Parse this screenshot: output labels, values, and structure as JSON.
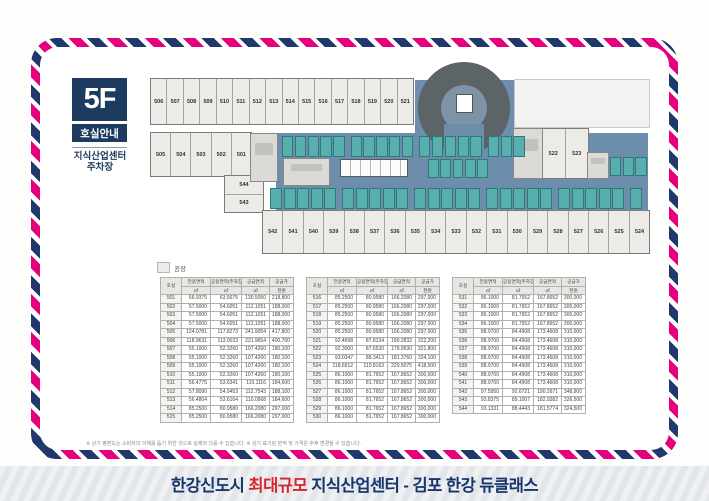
{
  "header": {
    "floor_badge": "5F",
    "badge_subtitle": "호실안내",
    "building_type_line1": "지식산업센터",
    "building_type_line2": "주차장"
  },
  "legend": {
    "factory_label": "공장"
  },
  "floorplan": {
    "top_row": [
      "506",
      "507",
      "508",
      "509",
      "510",
      "511",
      "512",
      "513",
      "514",
      "515",
      "516",
      "517",
      "518",
      "519",
      "520",
      "521"
    ],
    "left_row": [
      "505",
      "504",
      "503",
      "502",
      "501"
    ],
    "left_stack": [
      "544",
      "543"
    ],
    "right_units": [
      "522",
      "523"
    ],
    "bottom_row": [
      "542",
      "541",
      "540",
      "539",
      "538",
      "537",
      "536",
      "535",
      "534",
      "533",
      "532",
      "531",
      "530",
      "529",
      "528",
      "527",
      "526",
      "525",
      "524"
    ]
  },
  "table_headers": {
    "unit": "호실",
    "exclusive_area": "전용면적",
    "common_area": "공용면적(주차장포함)",
    "supply_area": "공급면적",
    "price": "공급가",
    "sqm": "㎡",
    "currency": "천원"
  },
  "tables": {
    "group1": [
      [
        "501",
        "66.9375",
        "63.5675",
        "130.5050",
        "218,800"
      ],
      [
        "502",
        "57.5000",
        "54.6051",
        "112.1051",
        "188,000"
      ],
      [
        "503",
        "57.5000",
        "54.6051",
        "112.1051",
        "188,000"
      ],
      [
        "504",
        "57.5000",
        "54.6051",
        "112.1051",
        "188,000"
      ],
      [
        "505",
        "124.0781",
        "117.8273",
        "241.9054",
        "417,800"
      ],
      [
        "506",
        "118.9631",
        "113.0023",
        "231.9654",
        "400,700"
      ],
      [
        "507",
        "55.1000",
        "52.3260",
        "107.4260",
        "180,100"
      ],
      [
        "508",
        "55.1000",
        "52.3260",
        "107.4260",
        "180,100"
      ],
      [
        "509",
        "55.1000",
        "52.3260",
        "107.4260",
        "180,100"
      ],
      [
        "510",
        "55.1000",
        "52.3260",
        "107.4260",
        "180,100"
      ],
      [
        "511",
        "56.4775",
        "53.6341",
        "110.1116",
        "184,600"
      ],
      [
        "512",
        "57.8090",
        "54.9453",
        "112.7543",
        "188,100"
      ],
      [
        "513",
        "56.4804",
        "53.6164",
        "110.0968",
        "184,600"
      ],
      [
        "514",
        "85.2500",
        "80.9580",
        "166.2080",
        "297,000"
      ],
      [
        "515",
        "85.2500",
        "80.9580",
        "166.2080",
        "297,000"
      ]
    ],
    "group2": [
      [
        "516",
        "85.2500",
        "80.9580",
        "166.2080",
        "297,000"
      ],
      [
        "517",
        "85.2500",
        "80.9580",
        "166.2080",
        "297,000"
      ],
      [
        "518",
        "85.2500",
        "80.9580",
        "166.2080",
        "297,000"
      ],
      [
        "519",
        "85.2500",
        "80.9580",
        "166.2080",
        "297,000"
      ],
      [
        "520",
        "85.2500",
        "80.9580",
        "166.2080",
        "297,000"
      ],
      [
        "521",
        "92.4698",
        "87.8134",
        "180.2832",
        "322,200"
      ],
      [
        "522",
        "92.3000",
        "87.6530",
        "179.9530",
        "321,800"
      ],
      [
        "523",
        "93.0347",
        "88.3413",
        "181.3760",
        "324,100"
      ],
      [
        "524",
        "118.6912",
        "110.8163",
        "229.5075",
        "418,500"
      ],
      [
        "525",
        "86.1000",
        "81.7652",
        "167.8652",
        "300,000"
      ],
      [
        "526",
        "86.1000",
        "81.7652",
        "167.8652",
        "300,000"
      ],
      [
        "527",
        "86.1000",
        "81.7652",
        "167.8652",
        "300,000"
      ],
      [
        "528",
        "86.1000",
        "81.7652",
        "167.8652",
        "300,000"
      ],
      [
        "529",
        "86.1000",
        "81.7652",
        "167.8652",
        "300,000"
      ],
      [
        "530",
        "86.1000",
        "81.7652",
        "167.8652",
        "300,000"
      ]
    ],
    "group3": [
      [
        "531",
        "86.1000",
        "81.7652",
        "167.8652",
        "300,000"
      ],
      [
        "532",
        "86.1000",
        "81.7652",
        "167.8652",
        "300,000"
      ],
      [
        "533",
        "86.1000",
        "81.7652",
        "167.8652",
        "300,000"
      ],
      [
        "534",
        "86.1000",
        "81.7652",
        "167.8652",
        "300,000"
      ],
      [
        "535",
        "88.9700",
        "84.4908",
        "173.4608",
        "310,000"
      ],
      [
        "536",
        "88.9700",
        "84.4908",
        "173.4608",
        "310,000"
      ],
      [
        "537",
        "88.9700",
        "84.4908",
        "173.4608",
        "310,000"
      ],
      [
        "538",
        "88.9700",
        "84.4908",
        "173.4608",
        "310,000"
      ],
      [
        "539",
        "88.9700",
        "84.4908",
        "173.4608",
        "310,000"
      ],
      [
        "540",
        "88.9700",
        "84.4908",
        "173.4608",
        "310,000"
      ],
      [
        "541",
        "88.9700",
        "84.4908",
        "173.4608",
        "310,000"
      ],
      [
        "542",
        "97.5950",
        "92.6721",
        "190.2671",
        "348,900"
      ],
      [
        "543",
        "93.8375",
        "89.1007",
        "182.9382",
        "326,500"
      ],
      [
        "544",
        "93.1331",
        "88.4443",
        "181.5774",
        "324,500"
      ]
    ]
  },
  "footnote": "※ 상기 평면도는 소비자의 이해를 돕기 위한 것으로 실제와 다를 수 있습니다.    ※ 상기 표기된 면적 및 가격은 추후 변경될 수 있습니다.",
  "tagline": {
    "prefix": "한강신도시 ",
    "highlight": "최대규모",
    "middle": " 지식산업센터 - ",
    "brand": "김포 한강 듀클래스"
  },
  "colors": {
    "navy": "#1d3a5f",
    "pink": "#e6007e",
    "red_accent": "#d6252b",
    "deck_blue": "#6d8dac",
    "stall_teal": "#57b0ad",
    "unit_fill": "#edebe7"
  }
}
